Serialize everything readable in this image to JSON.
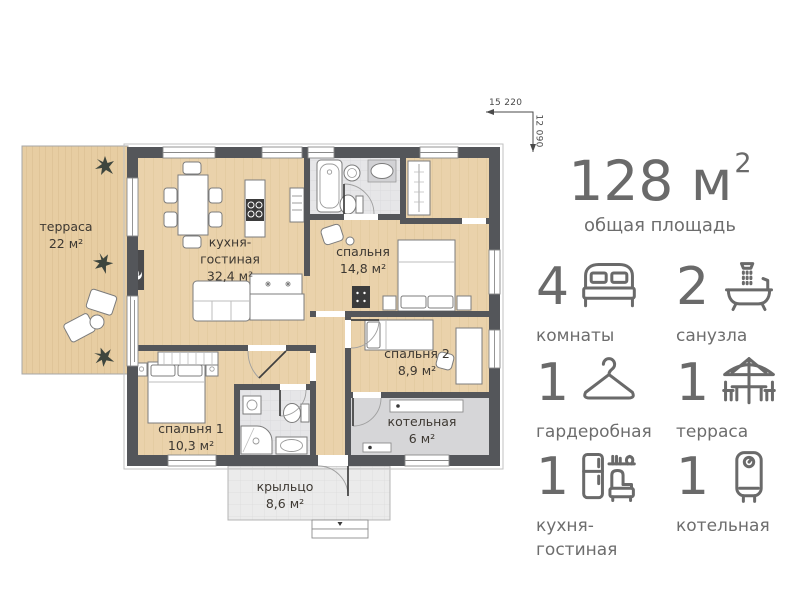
{
  "plan": {
    "dim_width_label": "15 220",
    "dim_height_label": "12 090",
    "rooms": {
      "terrace": {
        "name": "терраса",
        "area": "22 м²"
      },
      "kitchen_living": {
        "name": "кухня-\nгостиная",
        "area": "32,4 м²"
      },
      "bedroom": {
        "name": "спальня",
        "area": "14,8 м²"
      },
      "bedroom2": {
        "name": "спальня 2",
        "area": "8,9 м²"
      },
      "bedroom1": {
        "name": "спальня 1",
        "area": "10,3 м²"
      },
      "boiler": {
        "name": "котельная",
        "area": "6 м²"
      },
      "porch": {
        "name": "крыльцо",
        "area": "8,6 м²"
      }
    },
    "colors": {
      "wall": "#54565a",
      "wood_floor": "#ead2ab",
      "terrace_wood": "#e7cda2",
      "tile_floor": "#e6e6e8",
      "boiler_floor": "#d6d6d8",
      "label_text": "#3d3832"
    }
  },
  "summary": {
    "total_main": "128 м",
    "total_sup": "2",
    "total_caption": "общая площадь",
    "accent_color": "#6a6a6a",
    "stats": [
      {
        "count": "4",
        "label": "комнаты",
        "icon": "bed-icon"
      },
      {
        "count": "2",
        "label": "санузла",
        "icon": "bath-icon"
      },
      {
        "count": "1",
        "label": "гардеробная",
        "icon": "hanger-icon"
      },
      {
        "count": "1",
        "label": "терраса",
        "icon": "parasol-table-icon"
      },
      {
        "count": "1",
        "label": "кухня-\nгостиная",
        "icon": "kitchen-living-icon"
      },
      {
        "count": "1",
        "label": "котельная",
        "icon": "boiler-icon"
      }
    ]
  }
}
